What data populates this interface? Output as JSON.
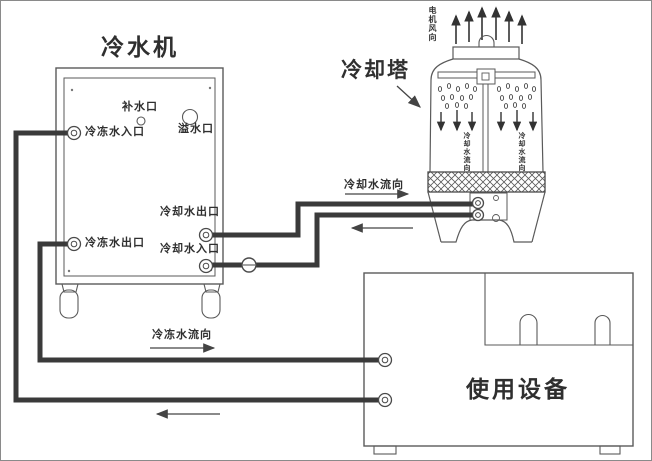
{
  "chiller": {
    "title": "冷水机",
    "makeup_port": "补水口",
    "overflow_port": "溢水口",
    "chilled_inlet": "冷冻水入口",
    "chilled_outlet": "冷冻水出口",
    "cooling_outlet": "冷却水出口",
    "cooling_inlet": "冷却水入口"
  },
  "cooling_tower": {
    "title": "冷却塔",
    "motor_wind": "电机风向",
    "inner_flow_left": "冷却水流向",
    "inner_flow_right": "冷却水流向"
  },
  "equipment": {
    "title": "使用设备"
  },
  "flow_labels": {
    "cooling": "冷却水流向",
    "chilled": "冷冻水流向"
  },
  "colors": {
    "line": "#4a4a4a",
    "pipe": "#3a3a3a",
    "text": "#2f2f2f",
    "background": "#ffffff"
  }
}
